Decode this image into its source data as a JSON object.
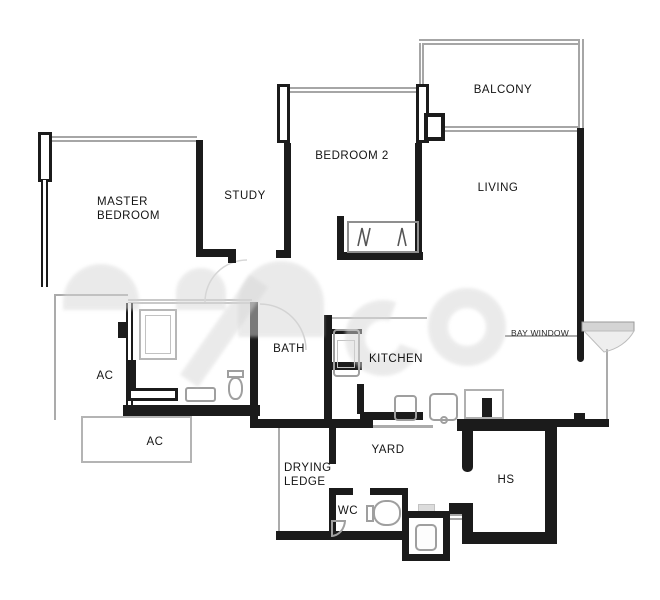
{
  "document": {
    "type": "apartment floor plan",
    "watermark_present": true,
    "watermark_text_legible": false
  },
  "colors": {
    "background": "#ffffff",
    "wall": "#1b1b1b",
    "window_line": "#a6a6a6",
    "fixture_line": "#9f9f9f",
    "watermark": "#d7d7d7",
    "label_text": "#141414"
  },
  "rooms": [
    {
      "id": "master-bedroom",
      "label": "MASTER\nBEDROOM"
    },
    {
      "id": "study",
      "label": "STUDY"
    },
    {
      "id": "bedroom-2",
      "label": "BEDROOM 2"
    },
    {
      "id": "balcony",
      "label": "BALCONY"
    },
    {
      "id": "living",
      "label": "LIVING"
    },
    {
      "id": "bath",
      "label": "BATH"
    },
    {
      "id": "kitchen",
      "label": "KITCHEN"
    },
    {
      "id": "bay-window",
      "label": "BAY WINDOW"
    },
    {
      "id": "ac-ledge-upper",
      "label": "AC"
    },
    {
      "id": "ac-ledge-lower",
      "label": "AC"
    },
    {
      "id": "drying-ledge",
      "label": "DRYING\nLEDGE"
    },
    {
      "id": "yard",
      "label": "YARD"
    },
    {
      "id": "wc",
      "label": "WC"
    },
    {
      "id": "household-shelter",
      "label": "HS"
    }
  ]
}
